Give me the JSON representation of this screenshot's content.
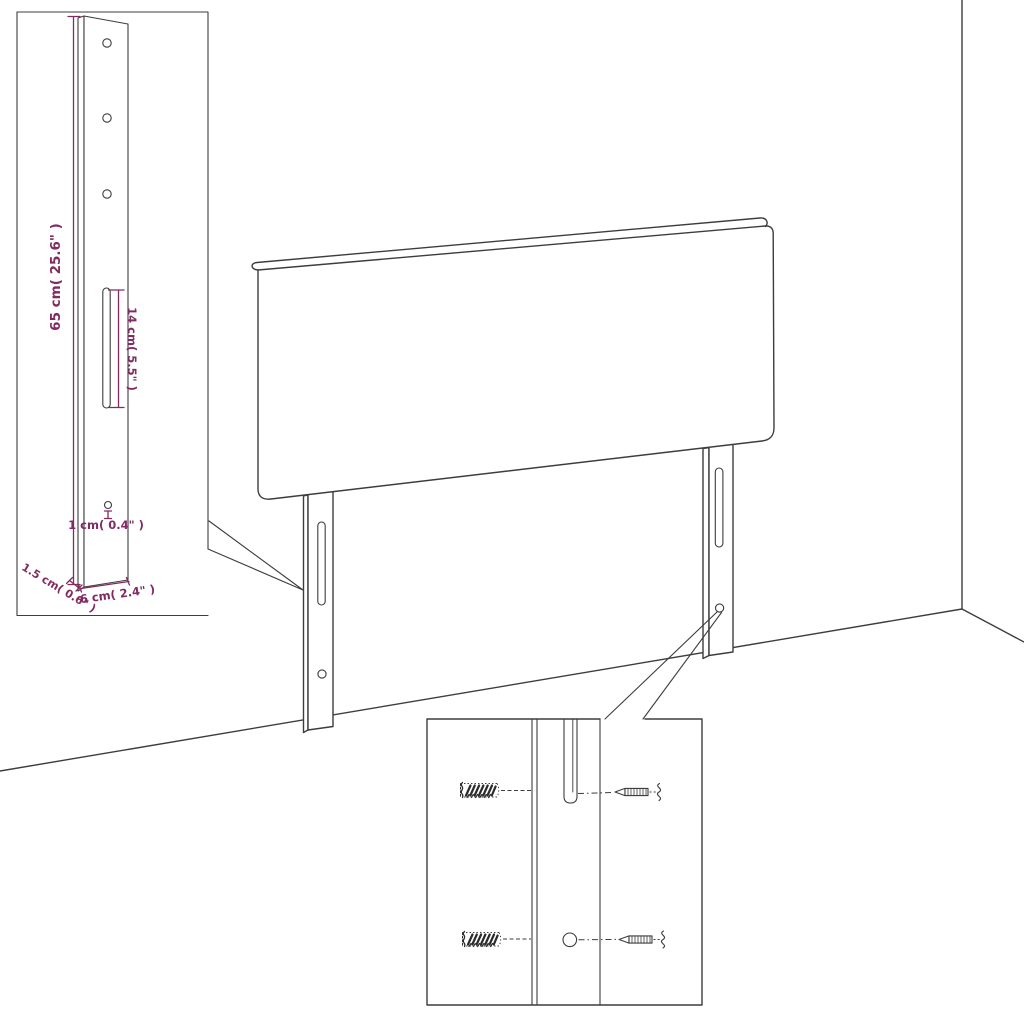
{
  "diagram": {
    "description": "Headboard with two slotted mounting legs shown in a room corner, with a leg dimension detail inset and a wall-mounting screw detail inset",
    "background": "#ffffff",
    "line_color": "#3d3d3d",
    "dimension_color": "#812b60",
    "leg_detail_inset": {
      "height_label": "65 cm( 25.6\" )",
      "slot_length_label": "14 cm( 5.5\" )",
      "hole_diameter_label": "1 cm( 0.4\" )",
      "thickness_label": "1.5 cm( 0.6\" )",
      "width_label": "6 cm( 2.4\" )"
    }
  }
}
